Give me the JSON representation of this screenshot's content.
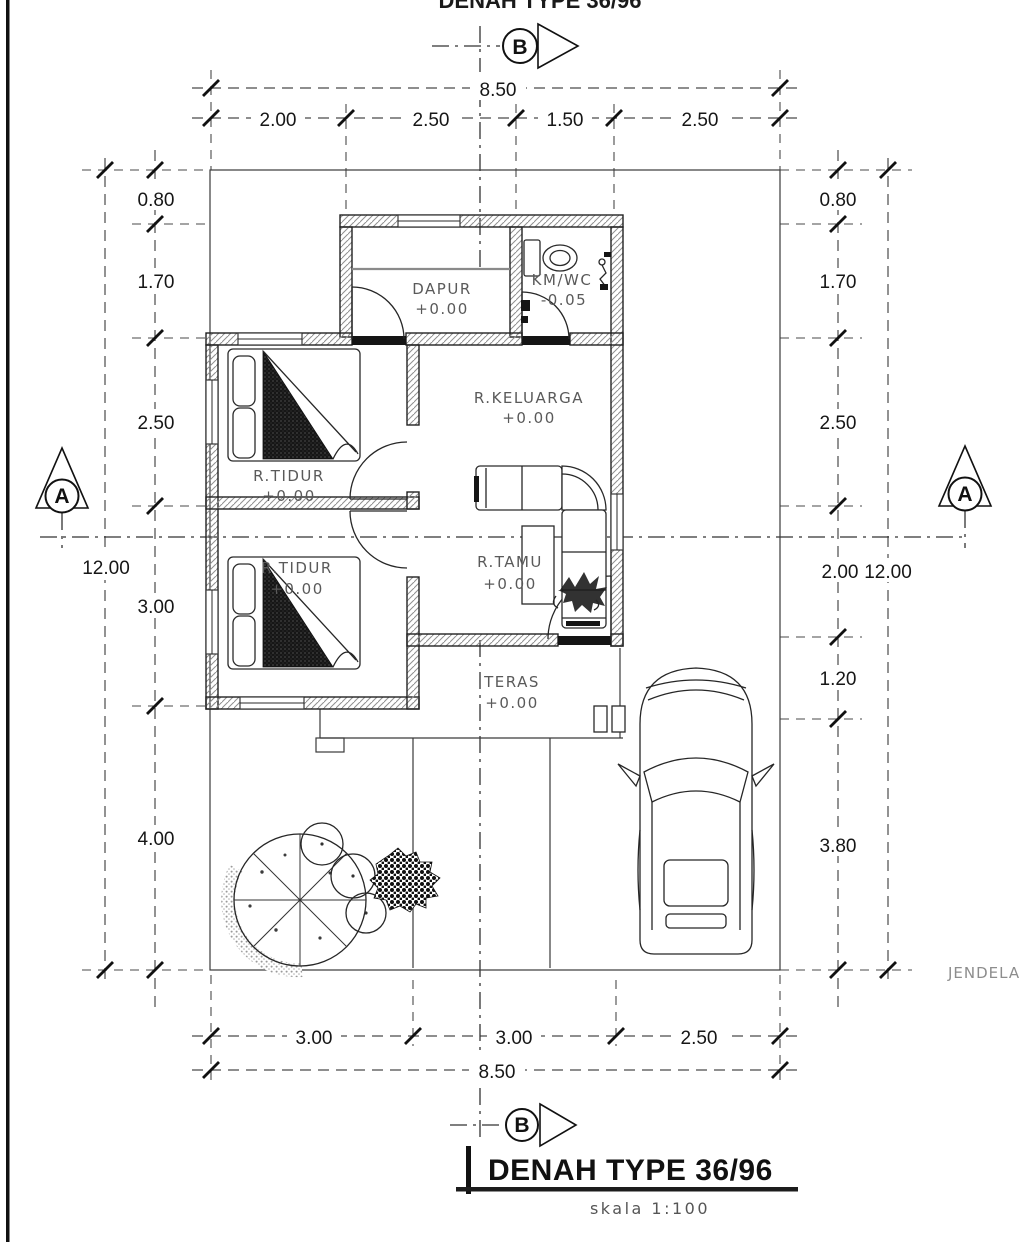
{
  "page": {
    "top_cropped_text": "DENAH TYPE 36/96",
    "side_note": "JENDELA K"
  },
  "title": {
    "text": "DENAH TYPE 36/96",
    "subtitle": "skala 1:100"
  },
  "markers": {
    "section_a": "A",
    "section_b": "B"
  },
  "dimensions": {
    "top": {
      "total": "8.50",
      "segments": [
        "2.00",
        "2.50",
        "1.50",
        "2.50"
      ]
    },
    "bottom": {
      "total": "8.50",
      "segments": [
        "3.00",
        "3.00",
        "2.50"
      ]
    },
    "left": {
      "total": "12.00",
      "segments": [
        "0.80",
        "1.70",
        "2.50",
        "3.00",
        "4.00"
      ]
    },
    "right": {
      "total": "12.00",
      "segments": [
        "0.80",
        "1.70",
        "2.50",
        "2.00",
        "1.20",
        "3.80"
      ]
    }
  },
  "rooms": {
    "dapur": {
      "name": "DAPUR",
      "level": "+0.00"
    },
    "kmwc": {
      "name": "KM/WC",
      "level": "-0.05"
    },
    "keluarga": {
      "name": "R.KELUARGA",
      "level": "+0.00"
    },
    "tidur1": {
      "name": "R.TIDUR",
      "level": "+0.00"
    },
    "tidur2": {
      "name": "R.TIDUR",
      "level": "+0.00"
    },
    "tamu": {
      "name": "R.TAMU",
      "level": "+0.00"
    },
    "teras": {
      "name": "TERAS",
      "level": "+0.00"
    }
  },
  "colors": {
    "ink": "#1a1a1a",
    "grey_label": "#5a5a5a",
    "page_bg": "#ffffff"
  }
}
